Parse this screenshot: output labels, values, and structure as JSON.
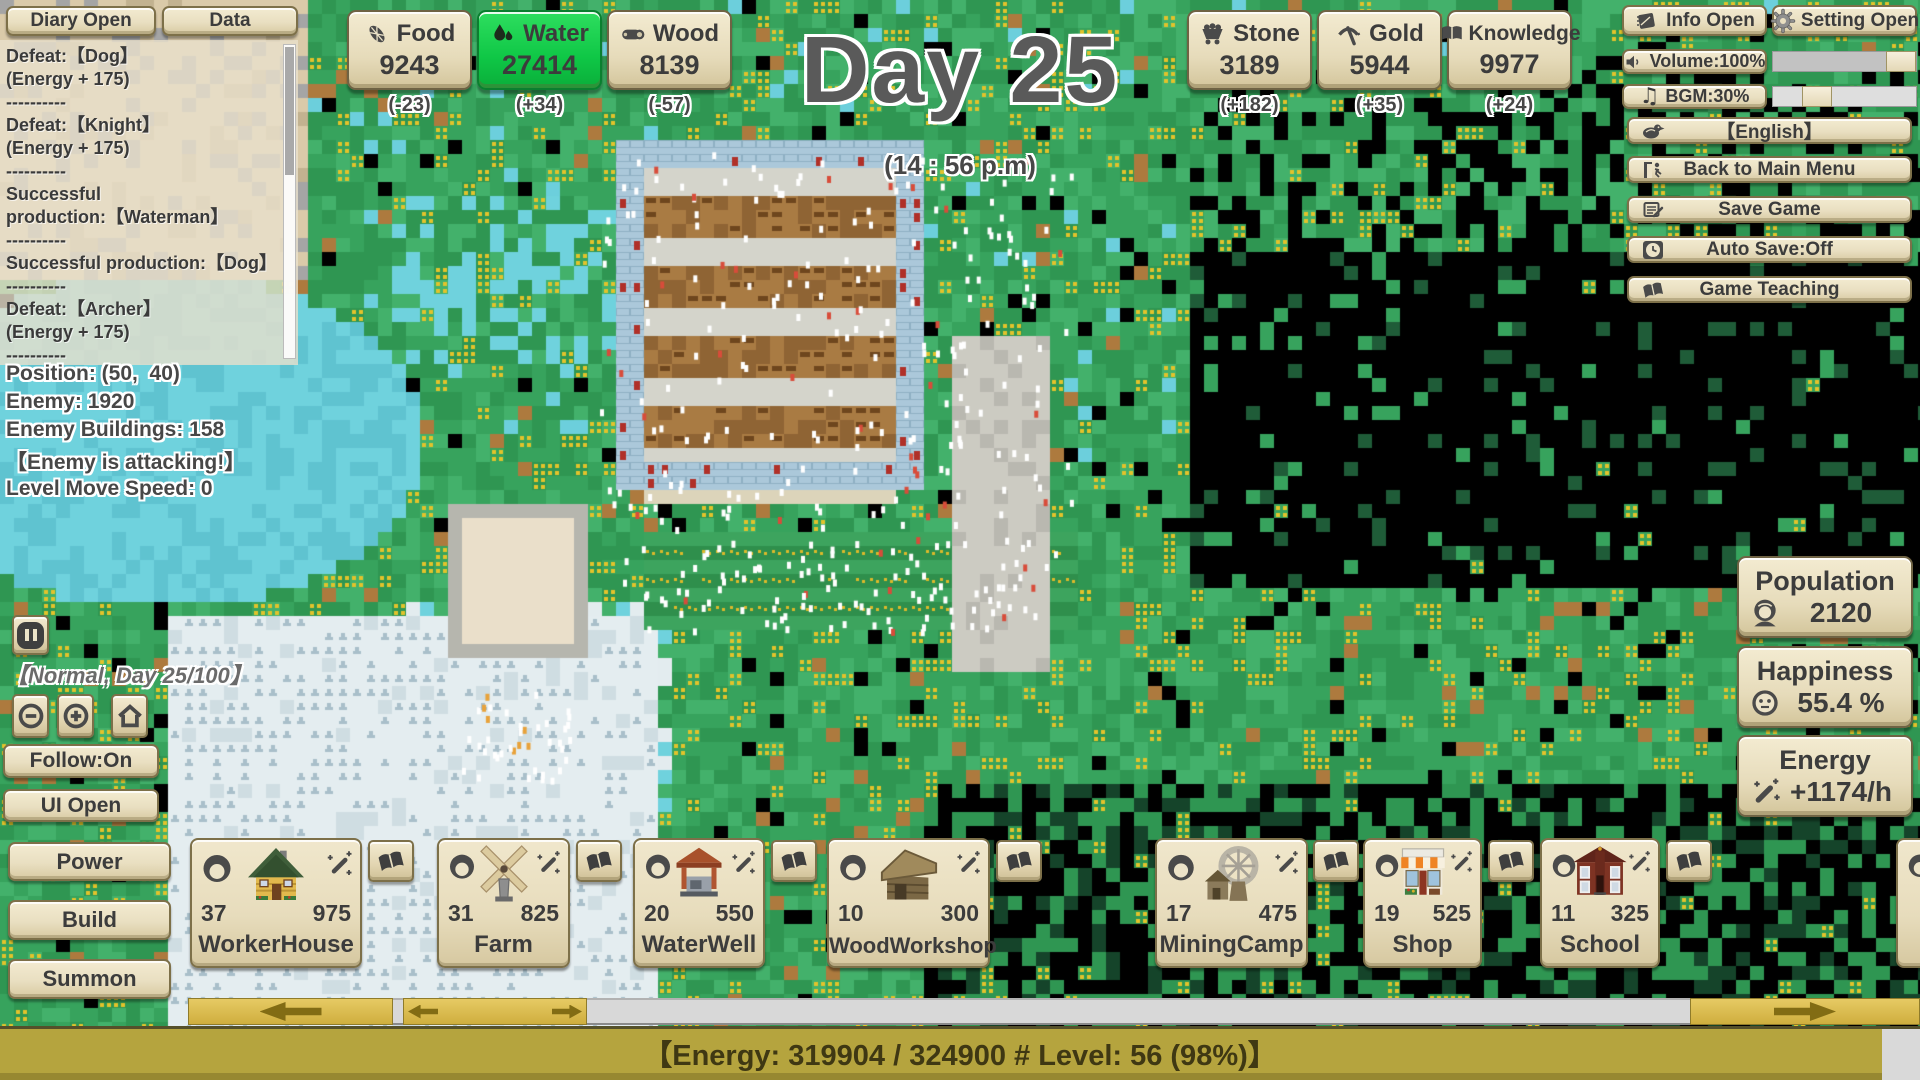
{
  "topbar": {
    "diary_button": "Diary Open",
    "data_button": "Data",
    "day_title": "Day 25",
    "time_subtitle": "(14 : 56 p.m)"
  },
  "log": {
    "lines": [
      "Defeat:【Dog】",
      "(Energy + 175)",
      "----------",
      "Defeat:【Knight】",
      "(Energy + 175)",
      "----------",
      "Successful",
      "production:【Waterman】",
      "----------",
      "Successful production:【Dog】",
      "----------",
      "Defeat:【Archer】",
      "(Energy + 175)",
      "----------"
    ]
  },
  "resources": [
    {
      "id": "food",
      "label": "Food",
      "value": "9243",
      "delta": "(-23)",
      "highlight": false
    },
    {
      "id": "water",
      "label": "Water",
      "value": "27414",
      "delta": "(+34)",
      "highlight": true
    },
    {
      "id": "wood",
      "label": "Wood",
      "value": "8139",
      "delta": "(-57)",
      "highlight": false
    },
    {
      "id": "stone",
      "label": "Stone",
      "value": "3189",
      "delta": "(+182)",
      "highlight": false
    },
    {
      "id": "gold",
      "label": "Gold",
      "value": "5944",
      "delta": "(+35)",
      "highlight": false
    },
    {
      "id": "knowledge",
      "label": "Knowledge",
      "value": "9977",
      "delta": "(+24)",
      "highlight": false
    }
  ],
  "settings": {
    "info_button": "Info Open",
    "setting_button": "Setting Open",
    "volume_button": "Volume:100%",
    "volume_percent": 100,
    "bgm_button": "BGM:30%",
    "bgm_percent": 30,
    "language_button": "【English】",
    "back_button": "Back to Main Menu",
    "save_button": "Save Game",
    "autosave_button": "Auto Save:Off",
    "teaching_button": "Game Teaching"
  },
  "status": {
    "position": "Position: (50,  40)",
    "enemy": "Enemy: 1920",
    "enemy_buildings": "Enemy Buildings: 158",
    "alert": "【Enemy is attacking!】",
    "move_speed": "Level Move Speed: 0",
    "mode_day": "【Normal, Day 25/100】",
    "follow_button": "Follow:On",
    "ui_button": "UI Open",
    "power_button": "Power",
    "build_button": "Build",
    "summon_button": "Summon"
  },
  "stats": {
    "population": {
      "label": "Population",
      "value": "2120"
    },
    "happiness": {
      "label": "Happiness",
      "value": "55.4 %"
    },
    "energy": {
      "label": "Energy",
      "value": "+1174/h"
    }
  },
  "buildings": [
    {
      "name": "WorkerHouse",
      "count": "37",
      "cost": "975"
    },
    {
      "name": "Farm",
      "count": "31",
      "cost": "825"
    },
    {
      "name": "WaterWell",
      "count": "20",
      "cost": "550"
    },
    {
      "name": "WoodWorkshop",
      "count": "10",
      "cost": "300"
    },
    {
      "name": "MiningCamp",
      "count": "17",
      "cost": "475"
    },
    {
      "name": "Shop",
      "count": "19",
      "cost": "525"
    },
    {
      "name": "School",
      "count": "11",
      "cost": "325"
    }
  ],
  "bottom": {
    "energy_bar_text": "【Energy: 319904 / 324900 # Level: 56 (98%)】",
    "energy_fill_percent": 98
  },
  "icons": {
    "bgm_note": "♫"
  },
  "colors": {
    "water_highlight": "#12c643",
    "panel_beige": "#e9dfc1",
    "gold": "#d2b24a",
    "energy_fill": "#b5a43e"
  }
}
